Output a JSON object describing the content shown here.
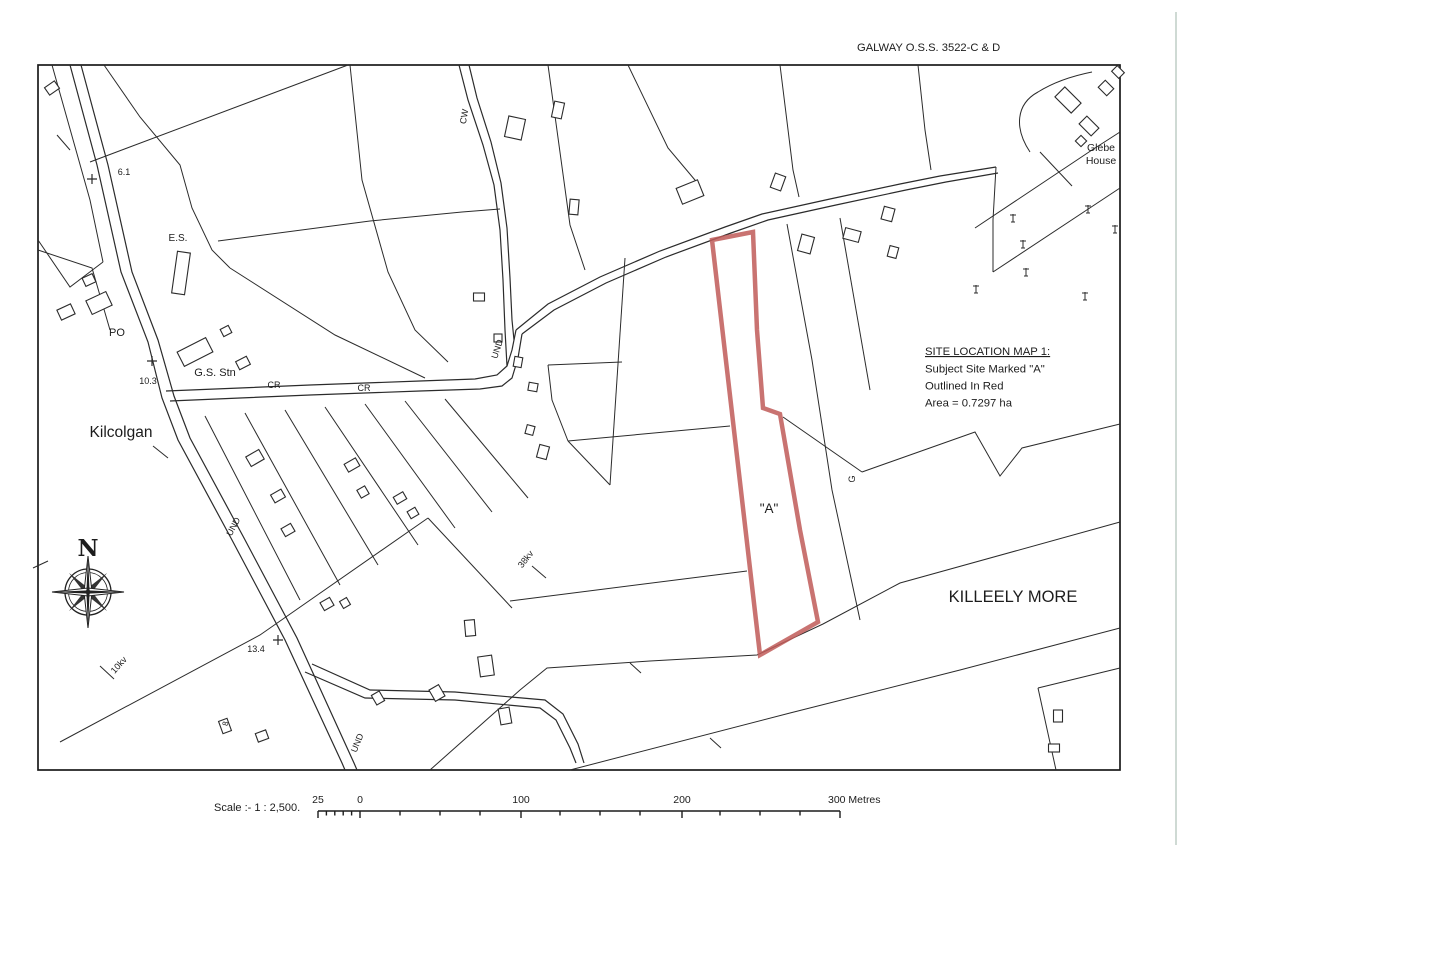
{
  "title": "GALWAY O.S.S. 3522-C & D",
  "colors": {
    "site_outline": "#c05a58",
    "map_line": "#2b2b2b",
    "page_edge": "#cfdad4"
  },
  "annotation": {
    "heading": "SITE LOCATION MAP 1:",
    "line1": "Subject Site Marked \"A\"",
    "line2": "Outlined In Red",
    "line3": "Area = 0.7297 ha"
  },
  "site": {
    "label": "\"A\""
  },
  "places": {
    "village": "Kilcolgan",
    "townland": "KILLEELY MORE",
    "glebe1": "Glebe",
    "glebe2": "House"
  },
  "labels": {
    "cw": "CW",
    "d61": "6.1",
    "es": "E.S.",
    "po": "PO",
    "d103": "10.3",
    "gs": "G.S. Stn",
    "cr1": "CR",
    "cr2": "CR",
    "und1": "UND",
    "und2": "UND",
    "und3": "UND",
    "kv38": "38kv",
    "kv10": "10kv",
    "d134": "13.4",
    "g": "G",
    "n8": "8"
  },
  "compass": {
    "north": "N"
  },
  "scalebar": {
    "label": "Scale :- 1 : 2,500.",
    "m25": "25",
    "m0": "0",
    "m100": "100",
    "m200": "200",
    "m300": "300 Metres"
  }
}
